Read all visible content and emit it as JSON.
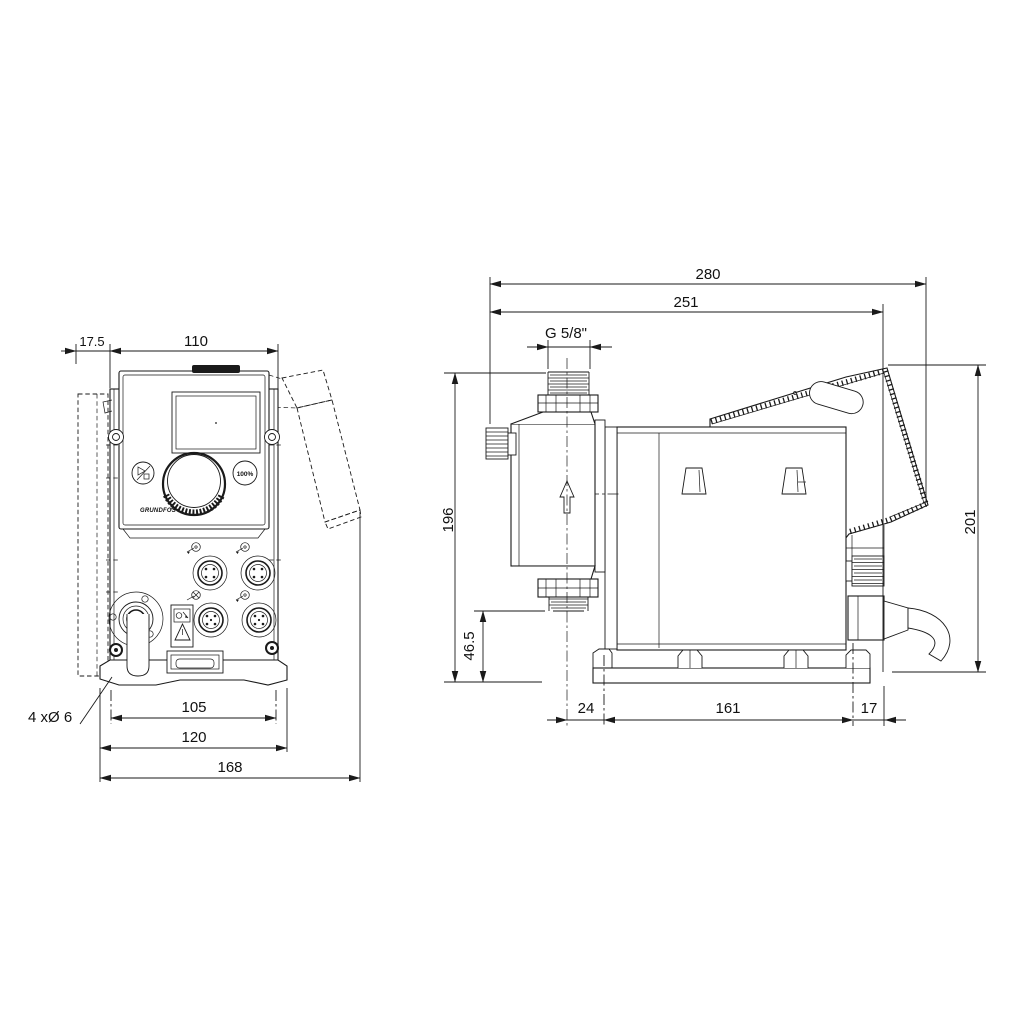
{
  "page": {
    "background": "#ffffff",
    "line_color": "#1a1a1a"
  },
  "front_view": {
    "bracket_depth": "17.5",
    "housing_width": "110",
    "hole_spacing": "105",
    "plate_width": "120",
    "overall_width": "168",
    "holes_note": "4 xØ 6",
    "panel": {
      "brand": "GRUNDFOS",
      "capacity_button": "100%"
    }
  },
  "side_view": {
    "overall_depth": "280",
    "panel_depth": "251",
    "thread": "G 5/8\"",
    "inlet_height": "196",
    "inlet_clearance": "46.5",
    "overall_height": "201",
    "front_offset": "24",
    "base_length": "161",
    "rear_offset": "17"
  }
}
